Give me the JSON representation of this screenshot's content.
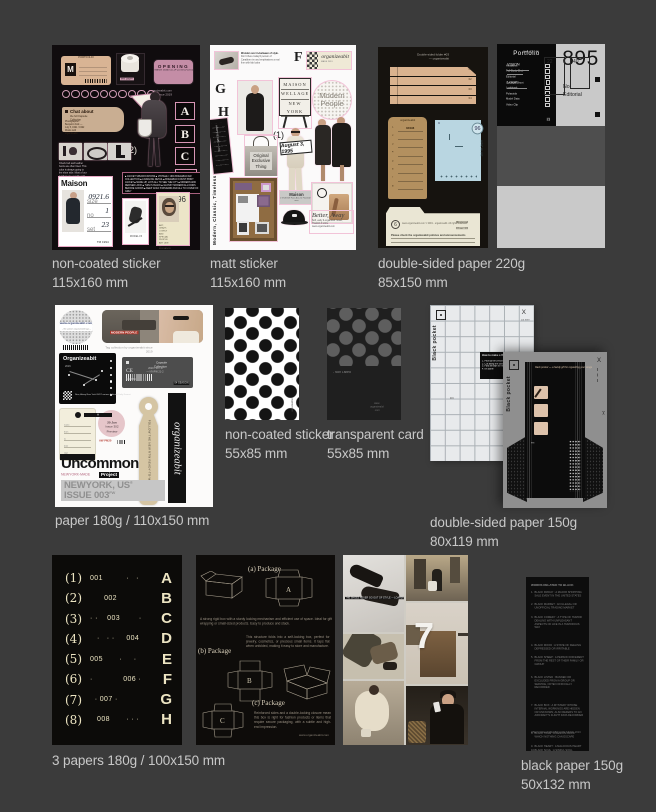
{
  "palette": {
    "background": "#3b3b3b",
    "caption": "#c8c8c8",
    "pink_accent": "#e9aec7",
    "tan": "#d9b494",
    "kraft": "#b3905f",
    "blue": "#b9d6e1",
    "cream": "#eae6d4"
  },
  "captions": {
    "s1": [
      "non-coated sticker",
      "115x160 mm"
    ],
    "s2": [
      "matt sticker",
      "115x160 mm"
    ],
    "p220": [
      "double-sided paper 220g",
      "85x150 mm"
    ],
    "p180": [
      "paper 180g / 110x150 mm"
    ],
    "dots": [
      "non-coated sticker",
      "55x85 mm"
    ],
    "tcard": [
      "transparent card",
      "55x85 mm"
    ],
    "p150": [
      "double-sided paper 150g",
      "80x119 mm"
    ],
    "p3": [
      "3 papers 180g / 100x150 mm"
    ],
    "bp": [
      "black paper 150g",
      "50x132 mm"
    ]
  },
  "s1": {
    "tag_header": "PORTFOLIO",
    "tag_letter": "M",
    "tape_label": "test paper",
    "badge_title": "OPENING",
    "badge_sub": "Maison Studio 10.14-25 09:00-18:00",
    "site_note": "organizeabit.com since 2019",
    "chat_title": "Chat about",
    "chat_line1": "the full Capsule Collection",
    "chat_line2": "Photographer: Benjamin Folk — July 5, 1991 / 1992 Works with organizeabit",
    "tri_text": "KINGDOM",
    "letters": [
      "A",
      "B",
      "C",
      "D"
    ],
    "num2": "(2)",
    "strip_note": "Check belt and leather boots are often liked. This color is always going to the shoe side. Most of our leathers are usually sold out in stock within hours.",
    "block_note": "■ JACKET SPECIFICATIONS ■ VINTAGE / 1991 BOHEMIAN AW COLLECTION ■ A DARLING DETAIL ■ BOHEMIAN COUNT PRINT JACKET ■ MADE-UP, LAYS ALL TO SEE THE CITY ■ MODERN AND REFINED LOOK ■ THIN IS BLACK ■ GLOSSY MODERN ALL KINDS BEFORE GOODS ■ KEEP GOLD STANDARD AND ALL TO COVER OF GREY",
    "maison_title": "Maison",
    "maison_f1_label": "size",
    "maison_f1_value": "0921.6",
    "maison_f2_label": "no",
    "maison_f2_value": "1",
    "maison_f3_label": "set",
    "maison_f3_value": "23",
    "maison_footer": "TM 1994",
    "card2_note": "MODEL'23",
    "card96_num": "96",
    "card96_note": "ART, CRAZY, LOVELY AND SPECIAL PEOPLE ART LIKE — ELEGANCE WANT AND FLORAL / GOLD PLAN — IN A TWO MODERN WAY"
  },
  "s2": {
    "text1_head": "Wonder over in-between of style.",
    "text1_body": "Don't there today'd person of Carabben im and emphasizes a real fine with fab looks",
    "letter_f": "F",
    "letter_g": "G",
    "letter_h": "H",
    "label1_script": "organizeabit",
    "label1_sub": "MADE 2019",
    "board_lines": [
      "MAISON",
      "WELLAGE",
      "NEW YORK"
    ],
    "modern_circle": "Modern People",
    "num1": "(1)",
    "bag_l1": "Original",
    "bag_l2": "Exclusive",
    "bag_l3": "Thing",
    "date_stamp": "August 3, 1995",
    "vtext": "Modern, Classic, Timeless",
    "bar_vtext": "ARCHIVE 1995 — NYC",
    "maison_label": "Maison",
    "maison_label_sub": "1 ST-MODE Faire Ave 23, Flamlind St. area",
    "cap_script": "Better, Away",
    "cap_note": "Soft, early & organized. Good, Thanks! A smile. www.organizeabit.com"
  },
  "p220a": {
    "header": "Double-sided folder #03 — organizeabit",
    "strip_labels": [
      "01",
      "02",
      "03",
      "04"
    ],
    "kraft_title": "organizeabit",
    "kraft_rows": [
      "1",
      "2",
      "3",
      "4",
      "5",
      "6",
      "7",
      "8"
    ],
    "kraft_entry": "03/196",
    "blue_num": "5",
    "blue_corner": "96",
    "blue_vtext": "ARCHIVE",
    "cream_collection": "Collection No. 03/196",
    "cream_circ": "6",
    "cream_b1": "Business hours",
    "cream_b2": "9 am - 6 pm",
    "cream_lines": "www.organizeabit.com © 2019 - organizeabit. All rights reserved.",
    "cream_bold": "Please check the organizeabit policies and announcements"
  },
  "p220b": {
    "header": "Double-sided folder #03 — organizeabit",
    "a_label": "(A)",
    "rtw": "Ready-to-Wear / RTW",
    "portfolio_title": "Portfolio",
    "portfolio_items": [
      "Headshot",
      "Full Body Shot",
      "Editorial",
      "Concept Shoot",
      "Lookbook",
      "Polaroids",
      "Model Data",
      "Video Clip"
    ],
    "port_chip": "23",
    "big_num": "895",
    "num_label1": "No.",
    "num_label2": "Editorial",
    "line_label": "Line 03 - 46",
    "vision": "VISION",
    "look": "LOOK",
    "box1": "22",
    "box2": "40"
  },
  "p180": {
    "circle_url": "www.organizeabit.com",
    "circle_sub": "- the uptown organizeabit tags -",
    "photo_label": "MODERN PEOPLE",
    "photo_note": "Tag collection by organizeabit since 2019",
    "black_title": "Organizeabit",
    "black_year": "2016",
    "black_addr": "New, Alwey New York 09/07 various Editorial Daily Format",
    "gray_title": "Capsule Collection",
    "gray_date": "2020 / 09 / 27 — NY/FW 21-2",
    "gray_ce": "CE",
    "gray_code": "844-5684",
    "gray_chip": "04 SEASON",
    "cream_footer": "2019 COLLECTION",
    "pink_chip": "A",
    "pink_l1": "20 Jun",
    "pink_l2": "Issue 302",
    "pink_l3": "Preview",
    "pink_stamp": "AW PM20",
    "tag_vtext": "FOLLOW THE NEW RTW READY-TO-WEAR SHOW",
    "banner_script": "organizeabit",
    "uncommon": "Uncommon",
    "uncommon_sub": "NEWYORK-MADE",
    "uncommon_chip": "Project",
    "issue_line1": "NEWYORK, US",
    "issue_reg": "®",
    "issue_line2": "ISSUE 003",
    "issue_sup": "FW"
  },
  "dw": {
    "side_note": "organizeabit"
  },
  "dd": {
    "listed": "- Non Listed",
    "foot": "www. organizeabit .com"
  },
  "p150": {
    "g1_vtext": "Black pocket",
    "g1_x": "X",
    "g1_cut": "cut here",
    "g1_box_title": "How to make a Black Pocket",
    "g1_box_lines": [
      "1. Pick up the prepared sheet with scissors, cutter & folder",
      "2. Cut along the dashed lines",
      "3. Fold all flaps at the line and attach them to the glue edge",
      "4. It's done!"
    ],
    "g1_fn": "FN",
    "g2_vtext": "Black pocket",
    "g2_x": "X",
    "g2_scissors": "✂",
    "g2_script1": "black pocket —",
    "g2_script2": "a handy gift for organizing your songs",
    "g2_fn": "FN"
  },
  "p3": {
    "rows": [
      {
        "num": "(1)",
        "mid": "001          ·   ·",
        "letter": "A"
      },
      {
        "num": "(2)",
        "mid": "      002",
        "letter": "B"
      },
      {
        "num": "(3)",
        "mid": "· ·    003        ·",
        "letter": "C"
      },
      {
        "num": "(4)",
        "mid": "   ·   · ·     004",
        "letter": "D"
      },
      {
        "num": "(5)",
        "mid": "005       ·     ·",
        "letter": "E"
      },
      {
        "num": "(6)",
        "mid": "·             006 ·",
        "letter": "F"
      },
      {
        "num": "(7)",
        "mid": "  · 007 ·",
        "letter": "G"
      },
      {
        "num": "(8)",
        "mid": "   008       · · ·",
        "letter": "H"
      }
    ]
  },
  "pkg": {
    "head_a": "(a) Package",
    "head_b": "(b) Package",
    "head_c": "(c) Package",
    "label_a": "A",
    "label_b": "B",
    "label_c": "C",
    "para1": "A strong rigid box with a sturdy locking mechanism and efficient use of space. Ideal for gift wrapping or small-sized products. Easy to produce and stack.",
    "para2": "This structure folds into a self-locking box, perfect for jewelry, cosmetics, or precious small items. It taps flat when unfolded, making it easy to store and manufacture.",
    "para3": "Reinforced sides and a double-locking closure mean this box is right for fashion products or items that require secure packaging, with a subtle and high-end impression.",
    "site": "www.organizeabit.com"
  },
  "collage": {
    "seven": "7",
    "shoes_note": "THE SHOES NEVER GO OUT OF STYLE — LOAFERS"
  },
  "bp": {
    "title": "WORDS RELATED TO BLACK",
    "items": [
      "BLACK FRIDAY : A MAJOR SHOPPING SALE EVENT IN THE UNITED STATES",
      "BLACK MARKET : AN ILLEGAL OR UNOFFICIAL TRADING MARKET",
      "BLACK COMEDY : A TYPE OF HUMOR DEALING WITH UNPLEASANT ASPECTS OF LIFE IN A HUMOROUS WAY",
      "BLACK MOOD : A STATE OF FEELING DEPRESSED OR IRRITABLE",
      "BLACK SHEEP : A PERSON DIFFERENT FROM THE REST OF THEIR FAMILY OR GROUP",
      "BLACK LISTED : BANNED OR EXCLUDED FROM A GROUP OR SERVICE, OFTEN OFFICIALLY RECORDED",
      "BLACK BOX : A MYSTERY WHOSE INTERNAL WORKINGS ARE HIDDEN OR UNKNOWN; ALSO REFERS TO AN AIRCRAFT'S FLIGHT DATA RECORDER",
      "BLACK HOLE : A REGION FROM WHICH NOTHING CAN ESCAPE",
      "BLACK HEART : A MALICIOUS HEART",
      "BLACK SOUL : A SINFUL SOUL",
      "BLACK THOUGHTS : DEPRESSED OR NEGATIVE THOUGHTS",
      "BLACK LABEL : A HIGH-END OR PREMIUM BRAND PRODUCT",
      "BLACKMAIL : THREAT OR EXTORTION USING SENSITIVE INFORMATION"
    ],
    "footer": "WWW.ORGANIZEABIT.COM SINCE 2019"
  }
}
